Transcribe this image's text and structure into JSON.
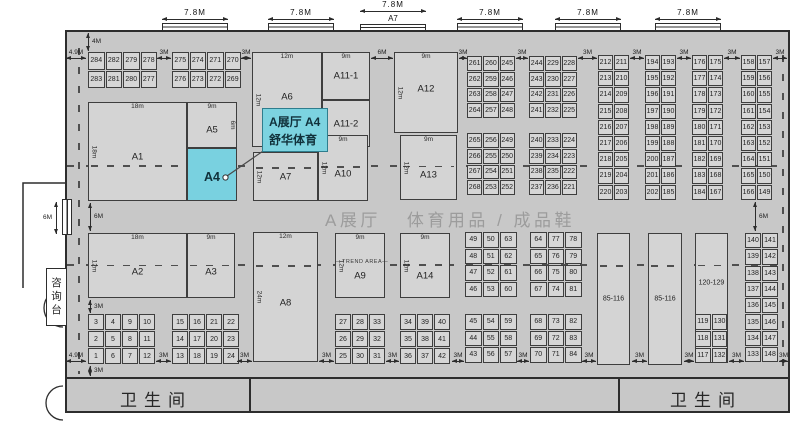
{
  "callout": {
    "line1": "A展厅 A4",
    "line2": "舒华体育"
  },
  "aisle": {
    "part1": "A展厅",
    "part2": "体育用品 / 成品鞋"
  },
  "restrooms": {
    "left": "卫生间",
    "right": "卫生间"
  },
  "info_desk": {
    "text": "咨询台"
  },
  "colors": {
    "hall_bg": "#c8c8c8",
    "cell_bg": "#d6d6d6",
    "highlight": "#79d1e0",
    "callout_border": "#2e7d8d",
    "wall": "#2d2d2d",
    "aisle_text": "#9c9c9c"
  },
  "entrances": [
    {
      "x": 162,
      "w": 66,
      "dim": "7.8M",
      "label": ""
    },
    {
      "x": 268,
      "w": 66,
      "dim": "7.8M",
      "label": ""
    },
    {
      "x": 360,
      "w": 66,
      "dim": "7.8M",
      "label": "A7"
    },
    {
      "x": 457,
      "w": 66,
      "dim": "7.8M",
      "label": ""
    },
    {
      "x": 555,
      "w": 66,
      "dim": "7.8M",
      "label": ""
    },
    {
      "x": 655,
      "w": 66,
      "dim": "7.8M",
      "label": ""
    }
  ],
  "blocks": [
    {
      "label": "A1",
      "x": 88,
      "y": 102,
      "w": 99,
      "h": 99,
      "t": "18m",
      "l": "18m",
      "ly": 0.56,
      "dash": 0.64
    },
    {
      "label": "A5",
      "x": 187,
      "y": 102,
      "w": 50,
      "h": 46,
      "t": "9m",
      "r": "6m",
      "ly": 0.62
    },
    {
      "label": "A4",
      "x": 187,
      "y": 148,
      "w": 50,
      "h": 53,
      "hl": true,
      "ly": 0.55
    },
    {
      "label": "A6",
      "x": 252,
      "y": 52,
      "w": 70,
      "h": 95,
      "t": "12m",
      "l": "12m",
      "ly": 0.47
    },
    {
      "label": "A11-1",
      "x": 322,
      "y": 52,
      "w": 48,
      "h": 48,
      "t": "9m",
      "ly": 0.5
    },
    {
      "label": "A11-2",
      "x": 322,
      "y": 100,
      "w": 48,
      "h": 47,
      "ly": 0.5
    },
    {
      "label": "A12",
      "x": 394,
      "y": 52,
      "w": 64,
      "h": 81,
      "t": "9m",
      "l": "12m",
      "ly": 0.46
    },
    {
      "label": "A7",
      "x": 253,
      "y": 152,
      "w": 65,
      "h": 49,
      "l": "12m",
      "ly": 0.5,
      "dash": 0.3
    },
    {
      "label": "A10",
      "x": 318,
      "y": 135,
      "w": 50,
      "h": 66,
      "t": "9m",
      "l": "12m",
      "ly": 0.6,
      "dash": 0.47
    },
    {
      "label": "A13",
      "x": 400,
      "y": 135,
      "w": 57,
      "h": 65,
      "t": "9m",
      "l": "12m",
      "ly": 0.62,
      "dash": 0.47
    },
    {
      "label": "A2",
      "x": 88,
      "y": 233,
      "w": 99,
      "h": 65,
      "t": "18m",
      "l": "12m",
      "ly": 0.6,
      "dash": 0.49
    },
    {
      "label": "A3",
      "x": 187,
      "y": 233,
      "w": 48,
      "h": 65,
      "t": "9m",
      "ly": 0.6,
      "dash": 0.49
    },
    {
      "label": "A8",
      "x": 253,
      "y": 232,
      "w": 65,
      "h": 130,
      "t": "12m",
      "l": "24m",
      "ly": 0.55,
      "dash": 0.25
    },
    {
      "label": "A9",
      "x": 335,
      "y": 233,
      "w": 50,
      "h": 65,
      "t": "9m",
      "l": "12m",
      "ly": 0.67,
      "note": "—TREND AREA—",
      "noteY": 0.42
    },
    {
      "label": "A14",
      "x": 400,
      "y": 233,
      "w": 50,
      "h": 65,
      "t": "9m",
      "l": "12m",
      "ly": 0.67,
      "dash": 0.48
    },
    {
      "label": "85-116",
      "x": 597,
      "y": 233,
      "w": 33,
      "h": 132,
      "small": true,
      "ly": 0.5,
      "dash": 0.24
    },
    {
      "label": "85-116",
      "x": 648,
      "y": 233,
      "w": 34,
      "h": 132,
      "small": true,
      "ly": 0.5,
      "dash": 0.24
    },
    {
      "label": "120-129",
      "x": 695,
      "y": 233,
      "w": 33,
      "h": 130,
      "small": true,
      "ly": 0.38,
      "dash": 0.24
    }
  ],
  "grids": [
    {
      "x": 88,
      "y": 52,
      "cw": 16.5,
      "ch": 17.5,
      "rows": [
        [
          284,
          282,
          279,
          278
        ],
        [
          283,
          281,
          280,
          277
        ]
      ]
    },
    {
      "x": 172,
      "y": 52,
      "cw": 16.5,
      "ch": 17.5,
      "rows": [
        [
          275,
          274,
          271,
          270
        ],
        [
          276,
          273,
          272,
          269
        ]
      ]
    },
    {
      "x": 467,
      "y": 56,
      "cw": 15.3,
      "ch": 14.8,
      "rows": [
        [
          261,
          260,
          245
        ],
        [
          262,
          259,
          246
        ],
        [
          263,
          258,
          247
        ],
        [
          264,
          257,
          248
        ]
      ]
    },
    {
      "x": 467,
      "y": 133,
      "cw": 15.3,
      "ch": 14.8,
      "rows": [
        [
          265,
          256,
          249
        ],
        [
          266,
          255,
          250
        ],
        [
          267,
          254,
          251
        ],
        [
          268,
          253,
          252
        ]
      ]
    },
    {
      "x": 529,
      "y": 56,
      "cw": 15.3,
      "ch": 14.8,
      "rows": [
        [
          244,
          229,
          228
        ],
        [
          243,
          230,
          227
        ],
        [
          242,
          231,
          226
        ],
        [
          241,
          232,
          225
        ]
      ]
    },
    {
      "x": 529,
      "y": 133,
      "cw": 15.3,
      "ch": 14.8,
      "rows": [
        [
          240,
          233,
          224
        ],
        [
          239,
          234,
          223
        ],
        [
          238,
          235,
          222
        ],
        [
          237,
          236,
          221
        ]
      ]
    },
    {
      "x": 598,
      "y": 55,
      "cw": 15,
      "ch": 15.2,
      "rows": [
        [
          212,
          211
        ],
        [
          213,
          210
        ],
        [
          214,
          209
        ],
        [
          215,
          208
        ],
        [
          216,
          207
        ],
        [
          217,
          206
        ],
        [
          218,
          205
        ],
        [
          219,
          204
        ],
        [
          220,
          203
        ]
      ]
    },
    {
      "x": 645,
      "y": 55,
      "cw": 15,
      "ch": 15.2,
      "rows": [
        [
          194,
          193
        ],
        [
          195,
          192
        ],
        [
          196,
          191
        ],
        [
          197,
          190
        ],
        [
          198,
          189
        ],
        [
          199,
          188
        ],
        [
          200,
          187
        ],
        [
          201,
          186
        ],
        [
          202,
          185
        ]
      ]
    },
    {
      "x": 692,
      "y": 55,
      "cw": 15,
      "ch": 15.2,
      "rows": [
        [
          176,
          175
        ],
        [
          177,
          174
        ],
        [
          178,
          173
        ],
        [
          179,
          172
        ],
        [
          180,
          171
        ],
        [
          181,
          170
        ],
        [
          182,
          169
        ],
        [
          183,
          168
        ],
        [
          184,
          167
        ]
      ]
    },
    {
      "x": 741,
      "y": 55,
      "cw": 15,
      "ch": 15.2,
      "rows": [
        [
          158,
          157
        ],
        [
          159,
          156
        ],
        [
          160,
          155
        ],
        [
          161,
          154
        ],
        [
          162,
          153
        ],
        [
          163,
          152
        ],
        [
          164,
          151
        ],
        [
          165,
          150
        ],
        [
          166,
          149
        ]
      ]
    },
    {
      "x": 88,
      "y": 314,
      "cw": 16,
      "ch": 16,
      "rows": [
        [
          3,
          4,
          9,
          10
        ],
        [
          2,
          5,
          8,
          11
        ],
        [
          1,
          6,
          7,
          12
        ]
      ]
    },
    {
      "x": 172,
      "y": 314,
      "cw": 16,
      "ch": 16,
      "rows": [
        [
          15,
          16,
          21,
          22
        ],
        [
          14,
          17,
          20,
          23
        ],
        [
          13,
          18,
          19,
          24
        ]
      ]
    },
    {
      "x": 335,
      "y": 314,
      "cw": 16,
      "ch": 16,
      "rows": [
        [
          27,
          28,
          33
        ],
        [
          26,
          29,
          32
        ],
        [
          25,
          30,
          31
        ]
      ]
    },
    {
      "x": 400,
      "y": 314,
      "cw": 16,
      "ch": 16,
      "rows": [
        [
          34,
          39,
          40
        ],
        [
          35,
          38,
          41
        ],
        [
          36,
          37,
          42
        ]
      ]
    },
    {
      "x": 465,
      "y": 232,
      "cw": 16.5,
      "ch": 15.5,
      "rows": [
        [
          49,
          50,
          63
        ],
        [
          48,
          51,
          62
        ],
        [
          47,
          52,
          61
        ],
        [
          46,
          53,
          60
        ]
      ]
    },
    {
      "x": 465,
      "y": 314,
      "cw": 16.5,
      "ch": 15.5,
      "rows": [
        [
          45,
          54,
          59
        ],
        [
          44,
          55,
          58
        ],
        [
          43,
          56,
          57
        ]
      ]
    },
    {
      "x": 530,
      "y": 232,
      "cw": 16.5,
      "ch": 15.5,
      "rows": [
        [
          64,
          77,
          78
        ],
        [
          65,
          76,
          79
        ],
        [
          66,
          75,
          80
        ],
        [
          67,
          74,
          81
        ]
      ]
    },
    {
      "x": 530,
      "y": 314,
      "cw": 16.5,
      "ch": 15.5,
      "rows": [
        [
          68,
          73,
          82
        ],
        [
          69,
          72,
          83
        ],
        [
          70,
          71,
          84
        ]
      ]
    },
    {
      "x": 695,
      "y": 314,
      "cw": 15.7,
      "ch": 15.8,
      "rows": [
        [
          119,
          130
        ],
        [
          118,
          131
        ],
        [
          117,
          132
        ]
      ]
    },
    {
      "x": 745,
      "y": 233,
      "cw": 16,
      "ch": 15.3,
      "rows": [
        [
          140,
          141
        ],
        [
          139,
          142
        ],
        [
          138,
          143
        ],
        [
          137,
          144
        ],
        [
          136,
          145
        ],
        [
          135,
          146
        ],
        [
          134,
          147
        ],
        [
          133,
          148
        ]
      ]
    }
  ],
  "dims": [
    {
      "label": "4.9M",
      "o": "h",
      "x": 66,
      "y": 58,
      "len": 20
    },
    {
      "label": "3M",
      "o": "h",
      "x": 157,
      "y": 58,
      "len": 14
    },
    {
      "label": "3M",
      "o": "h",
      "x": 241,
      "y": 58,
      "len": 10
    },
    {
      "label": "6M",
      "o": "h",
      "x": 371,
      "y": 58,
      "len": 22
    },
    {
      "label": "3M",
      "o": "h",
      "x": 459,
      "y": 58,
      "len": 8
    },
    {
      "label": "3M",
      "o": "h",
      "x": 516,
      "y": 58,
      "len": 12
    },
    {
      "label": "3M",
      "o": "h",
      "x": 578,
      "y": 58,
      "len": 19
    },
    {
      "label": "3M",
      "o": "h",
      "x": 630,
      "y": 58,
      "len": 14
    },
    {
      "label": "3M",
      "o": "h",
      "x": 677,
      "y": 58,
      "len": 14
    },
    {
      "label": "3M",
      "o": "h",
      "x": 724,
      "y": 58,
      "len": 16
    },
    {
      "label": "3M",
      "o": "h",
      "x": 773,
      "y": 58,
      "len": 14
    },
    {
      "label": "4M",
      "o": "v",
      "x": 88,
      "y": 33,
      "len": 18
    },
    {
      "label": "6M",
      "o": "v",
      "x": 90,
      "y": 203,
      "len": 28
    },
    {
      "label": "3M",
      "o": "v",
      "x": 90,
      "y": 300,
      "len": 13
    },
    {
      "label": "3M",
      "o": "v",
      "x": 90,
      "y": 366,
      "len": 10
    },
    {
      "label": "6M",
      "o": "v",
      "x": 755,
      "y": 202,
      "len": 29
    },
    {
      "label": "6M",
      "o": "v",
      "x": 56,
      "y": 202,
      "len": 32,
      "ls": "l"
    },
    {
      "label": "4.9M",
      "o": "h",
      "x": 66,
      "y": 361,
      "len": 20
    },
    {
      "label": "3M",
      "o": "h",
      "x": 156,
      "y": 361,
      "len": 15
    },
    {
      "label": "3M",
      "o": "h",
      "x": 237,
      "y": 361,
      "len": 15
    },
    {
      "label": "3M",
      "o": "h",
      "x": 319,
      "y": 361,
      "len": 15
    },
    {
      "label": "3M",
      "o": "h",
      "x": 386,
      "y": 361,
      "len": 13
    },
    {
      "label": "3M",
      "o": "h",
      "x": 452,
      "y": 361,
      "len": 12
    },
    {
      "label": "3M",
      "o": "h",
      "x": 517,
      "y": 361,
      "len": 12
    },
    {
      "label": "3M",
      "o": "h",
      "x": 582,
      "y": 361,
      "len": 14
    },
    {
      "label": "3M",
      "o": "h",
      "x": 632,
      "y": 361,
      "len": 15
    },
    {
      "label": "3M",
      "o": "h",
      "x": 684,
      "y": 361,
      "len": 10
    },
    {
      "label": "3M",
      "o": "h",
      "x": 729,
      "y": 361,
      "len": 15
    },
    {
      "label": "3M",
      "o": "h",
      "x": 779,
      "y": 361,
      "len": 9
    }
  ]
}
